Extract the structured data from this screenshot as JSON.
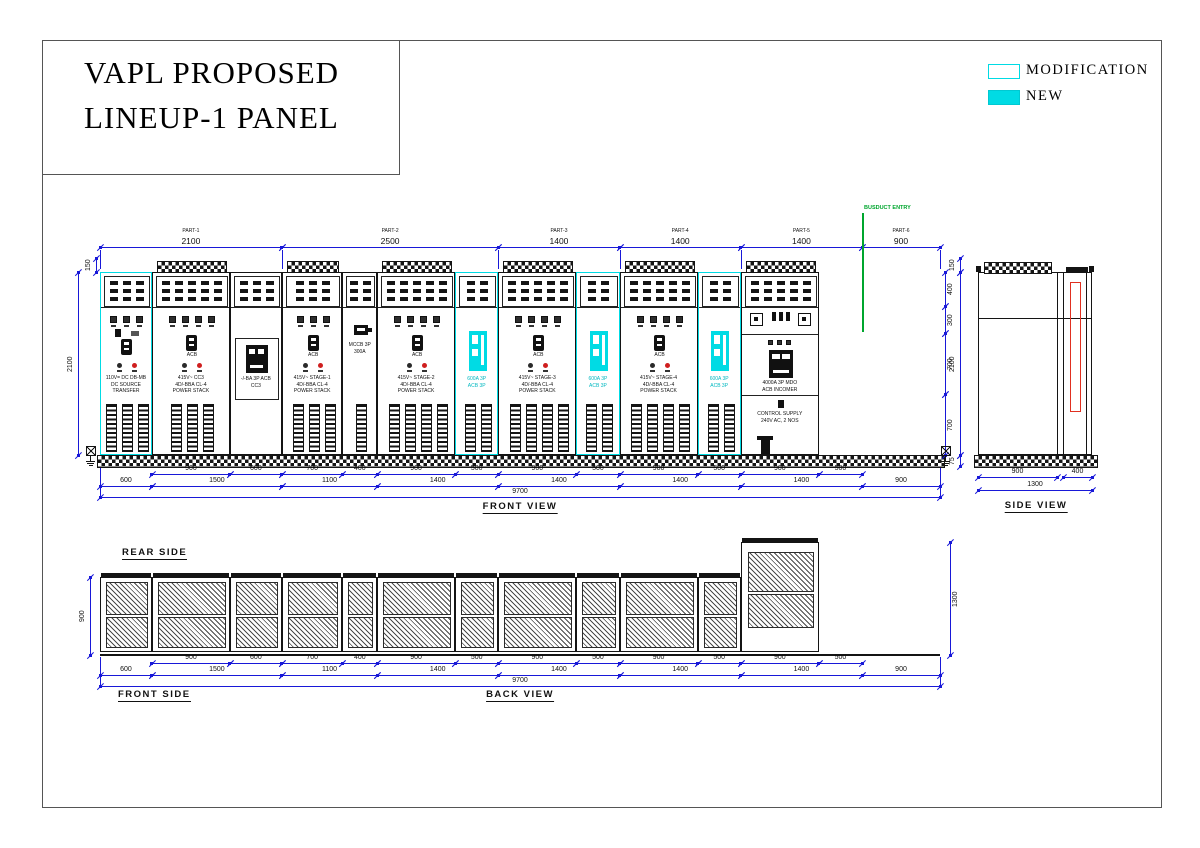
{
  "title_block": {
    "line1": "VAPL PROPOSED",
    "line2": "LINEUP-1  PANEL"
  },
  "legend": {
    "modification": "MODIFICATION",
    "new": "NEW"
  },
  "colors": {
    "dimension_blue": "#1818d8",
    "modification_cyan": "#00dbe4",
    "new_cyan": "#00dbe4",
    "busduct_green": "#00a62e",
    "busbar_red": "#e03020",
    "line_black": "#141414"
  },
  "front_view": {
    "label": "FRONT VIEW",
    "busduct_label": "BUSDUCT ENTRY",
    "total_mm": 9700,
    "parts": [
      {
        "name": "PART-1",
        "dim": "2100",
        "from": 0,
        "to": 2100
      },
      {
        "name": "PART-2",
        "dim": "2500",
        "from": 2100,
        "to": 4600
      },
      {
        "name": "PART-3",
        "dim": "1400",
        "from": 4600,
        "to": 6000
      },
      {
        "name": "PART-4",
        "dim": "1400",
        "from": 6000,
        "to": 7400
      },
      {
        "name": "PART-5",
        "dim": "1400",
        "from": 7400,
        "to": 8800
      },
      {
        "name": "PART-6",
        "dim": "900",
        "from": 8800,
        "to": 9700
      }
    ],
    "bays": [
      {
        "width": 600,
        "type": "transfer",
        "highlight": true,
        "meters": 3,
        "louvers": 3,
        "text": [
          "110V= DC DB-MB",
          "DC SOURCE",
          "TRANSFER"
        ]
      },
      {
        "width": 900,
        "type": "feeder",
        "highlight": false,
        "meters": 4,
        "louvers": 3,
        "acb": "ACB",
        "text": [
          "415V~ CC3",
          "4D/-BBA CL-4",
          "POWER STACK"
        ]
      },
      {
        "width": 600,
        "type": "spare_acb",
        "highlight": false,
        "text": [
          "-/-BA 3P ACB",
          "CC3"
        ]
      },
      {
        "width": 700,
        "type": "feeder",
        "highlight": false,
        "meters": 3,
        "louvers": 3,
        "acb": "ACB",
        "text": [
          "415V~ STAGE-1",
          "4D/-BBA CL-4",
          "POWER STACK"
        ]
      },
      {
        "width": 400,
        "type": "mccb",
        "highlight": false,
        "louvers": 1,
        "text": [
          "MCCB 3P",
          "300A"
        ]
      },
      {
        "width": 900,
        "type": "feeder",
        "highlight": false,
        "meters": 4,
        "louvers": 4,
        "acb": "ACB",
        "text": [
          "415V~ STAGE-2",
          "4D/-BBA CL-4",
          "POWER STACK"
        ]
      },
      {
        "width": 500,
        "type": "new_acb",
        "highlight": true,
        "louvers": 2,
        "text": [
          "600A 3P",
          "ACB 3P"
        ]
      },
      {
        "width": 900,
        "type": "feeder",
        "highlight": false,
        "meters": 4,
        "louvers": 4,
        "acb": "ACB",
        "text": [
          "415V~ STAGE-3",
          "4D/-BBA CL-4",
          "POWER STACK"
        ]
      },
      {
        "width": 500,
        "type": "new_acb",
        "highlight": true,
        "louvers": 2,
        "text": [
          "600A 3P",
          "ACB 3P"
        ]
      },
      {
        "width": 900,
        "type": "feeder",
        "highlight": false,
        "meters": 4,
        "louvers": 4,
        "acb": "ACB",
        "text": [
          "415V~ STAGE-4",
          "4D/-BBA CL-4",
          "POWER STACK"
        ]
      },
      {
        "width": 500,
        "type": "new_acb",
        "highlight": true,
        "louvers": 2,
        "text": [
          "600A 3P",
          "ACB 3P"
        ]
      },
      {
        "width": 900,
        "type": "incomer",
        "highlight": false,
        "text": [
          "4000A 3P MDO",
          "ACB INCOMER"
        ],
        "control_text": [
          "CONTROL SUPPLY",
          "240V AC, 2 NOS"
        ]
      }
    ],
    "height_dims_left": [
      {
        "label": "150"
      },
      {
        "label": "2100"
      }
    ],
    "height_dims_right": [
      {
        "label": "400",
        "from": 0,
        "to": 400
      },
      {
        "label": "300",
        "from": 400,
        "to": 700
      },
      {
        "label": "700",
        "from": 700,
        "to": 1400
      },
      {
        "label": "700",
        "from": 1400,
        "to": 2100
      }
    ]
  },
  "lineup_dims": {
    "row_a": [
      {
        "from": 600,
        "to": 1500,
        "label": "900"
      },
      {
        "from": 1500,
        "to": 2100,
        "label": "600"
      },
      {
        "from": 2100,
        "to": 2800,
        "label": "700"
      },
      {
        "from": 2800,
        "to": 3200,
        "label": "400"
      },
      {
        "from": 3200,
        "to": 4100,
        "label": "900"
      },
      {
        "from": 4100,
        "to": 4600,
        "label": "500"
      },
      {
        "from": 4600,
        "to": 5500,
        "label": "900"
      },
      {
        "from": 5500,
        "to": 6000,
        "label": "500"
      },
      {
        "from": 6000,
        "to": 6900,
        "label": "900"
      },
      {
        "from": 6900,
        "to": 7400,
        "label": "500"
      },
      {
        "from": 7400,
        "to": 8300,
        "label": "900"
      },
      {
        "from": 8300,
        "to": 8800,
        "label": "500"
      }
    ],
    "row_b": [
      {
        "from": 0,
        "to": 600,
        "label": "600"
      },
      {
        "from": 600,
        "to": 2100,
        "label": "1500"
      },
      {
        "from": 2100,
        "to": 3200,
        "label": "1100"
      },
      {
        "from": 3200,
        "to": 4600,
        "label": "1400"
      },
      {
        "from": 4600,
        "to": 6000,
        "label": "1400"
      },
      {
        "from": 6000,
        "to": 7400,
        "label": "1400"
      },
      {
        "from": 7400,
        "to": 8800,
        "label": "1400"
      },
      {
        "from": 8800,
        "to": 9700,
        "label": "900"
      }
    ],
    "total": {
      "from": 0,
      "to": 9700,
      "label": "9700"
    }
  },
  "side_view": {
    "label": "SIDE VIEW",
    "dims": {
      "front": "900",
      "rear": "400",
      "total": "1300",
      "top": "150",
      "height": "2100",
      "base": "75"
    }
  },
  "back_view": {
    "label": "BACK VIEW",
    "rear_label": "REAR SIDE",
    "front_label": "FRONT SIDE",
    "height": "900",
    "tall_height": "1300"
  }
}
